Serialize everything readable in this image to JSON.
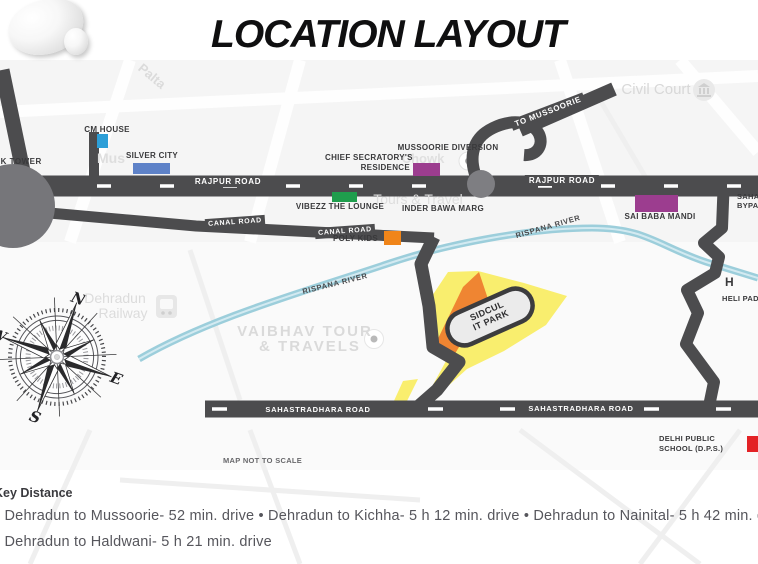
{
  "title": "LOCATION LAYOUT",
  "map": {
    "scale_note": "MAP NOT TO SCALE",
    "road_labels": {
      "clock_tower": "CLOCK TOWER",
      "rajpur_left": "RAJPUR ROAD",
      "rajpur_right": "RAJPUR ROAD",
      "canal_west": "CANAL ROAD",
      "canal_east": "CANAL ROAD",
      "to_mussoorie": "TO MUSSOORIE",
      "sahastradhara_west": "SAHASTRADHARA ROAD",
      "sahastradhara_east": "SAHASTRADHARA ROAD",
      "bypass_line1": "SAHASTRADHARA",
      "bypass_line2": "BYPASS",
      "inder_bawa_marg": "INDER BAWA MARG",
      "mussoorie_diversion": "MUSSOORIE DIVERSION"
    },
    "river_labels": {
      "west": "RISPANA RIVER",
      "east": "RISPANA RIVER"
    },
    "landmarks": {
      "cm_house": {
        "label": "CM HOUSE",
        "marker_color": "#2D9FD8"
      },
      "silver_city": {
        "label": "SILVER CITY",
        "marker_color": "#5E82C8"
      },
      "chief_secratorys_residence": {
        "line1": "CHIEF SECRATORY'S",
        "line2": "RESIDENCE",
        "marker_color": "#9C3D8F"
      },
      "vibezz_the_lounge": {
        "label": "VIBEZZ THE LOUNGE",
        "marker_color": "#1F9E4D"
      },
      "poly_kids": {
        "label": "POLY KIDS",
        "marker_color": "#F08519"
      },
      "sai_baba_mandi": {
        "label": "SAI BABA MANDI",
        "marker_color": "#9C3D8F"
      },
      "sidcul_it_park": {
        "line1": "SIDCUL",
        "line2": "IT PARK",
        "area_yellow": "#F9EE6E",
        "area_orange": "#EF8532"
      },
      "delhi_public_school": {
        "line1": "DELHI PUBLIC",
        "line2": "SCHOOL (D.P.S.)",
        "marker_color": "#E32226"
      },
      "heli_pad": {
        "line1": "H",
        "line2": "HELI PAD"
      }
    },
    "background_labels": {
      "palta": "Palta",
      "mus": "Mus",
      "chowk": "Chowk",
      "tours_travel": "Tours & Travel",
      "civil_court": "Civil Court",
      "railway_line1": "Dehradun",
      "railway_line2": "Railway",
      "vaibhav_line1": "VAIBHAV TOUR",
      "vaibhav_line2": "& TRAVELS"
    },
    "compass": {
      "north": "N",
      "east": "E",
      "south": "S",
      "west": "W"
    },
    "colors": {
      "road": "#4C4C4E",
      "river": "#97CBD9"
    }
  },
  "key_distance": {
    "heading": "Key Distance",
    "line1": "• Dehradun to Mussoorie- 52 min. drive • Dehradun to Kichha- 5 h 12 min. drive • Dehradun to Nainital- 5 h 42 min. drive",
    "line2": "• Dehradun to Haldwani- 5 h 21 min. drive"
  }
}
